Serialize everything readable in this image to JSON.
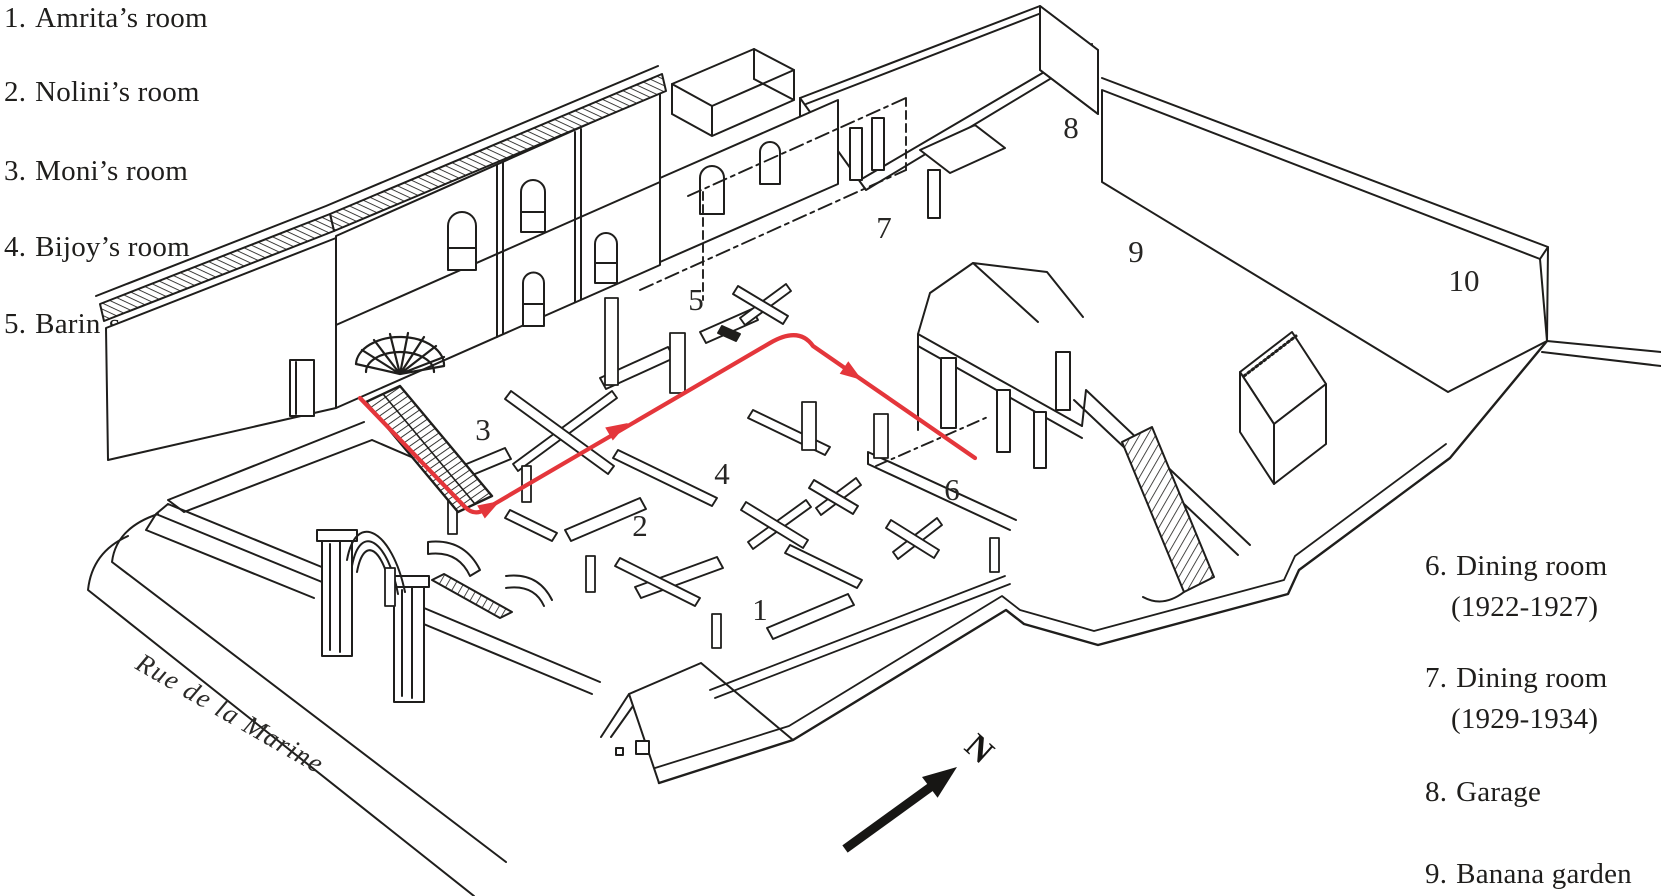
{
  "figure": {
    "kind": "axonometric building plan",
    "legend_left": {
      "items": [
        {
          "num": "1.",
          "label": "Amrita’s room"
        },
        {
          "num": "2.",
          "label": "Nolini’s room"
        },
        {
          "num": "3.",
          "label": "Moni’s room"
        },
        {
          "num": "4.",
          "label": "Bijoy’s room"
        },
        {
          "num": "5.",
          "label": "Barin’s room"
        }
      ]
    },
    "legend_right": {
      "items": [
        {
          "num": "6.",
          "label": "Dining room",
          "years": "(1922-1927)"
        },
        {
          "num": "7.",
          "label": "Dining room",
          "years": "(1929-1934)"
        },
        {
          "num": "8.",
          "label": "Garage",
          "years": ""
        },
        {
          "num": "9.",
          "label": "Banana garden",
          "years": ""
        }
      ]
    },
    "plan": {
      "numbers": [
        "1",
        "2",
        "3",
        "4",
        "5",
        "6",
        "7",
        "8",
        "9",
        "10"
      ],
      "street_label": "Rue de la Marine",
      "north_label": "N"
    },
    "colors": {
      "ink": "#1f1e1c",
      "route_red": "#e4363b",
      "paper": "#ffffff"
    }
  }
}
